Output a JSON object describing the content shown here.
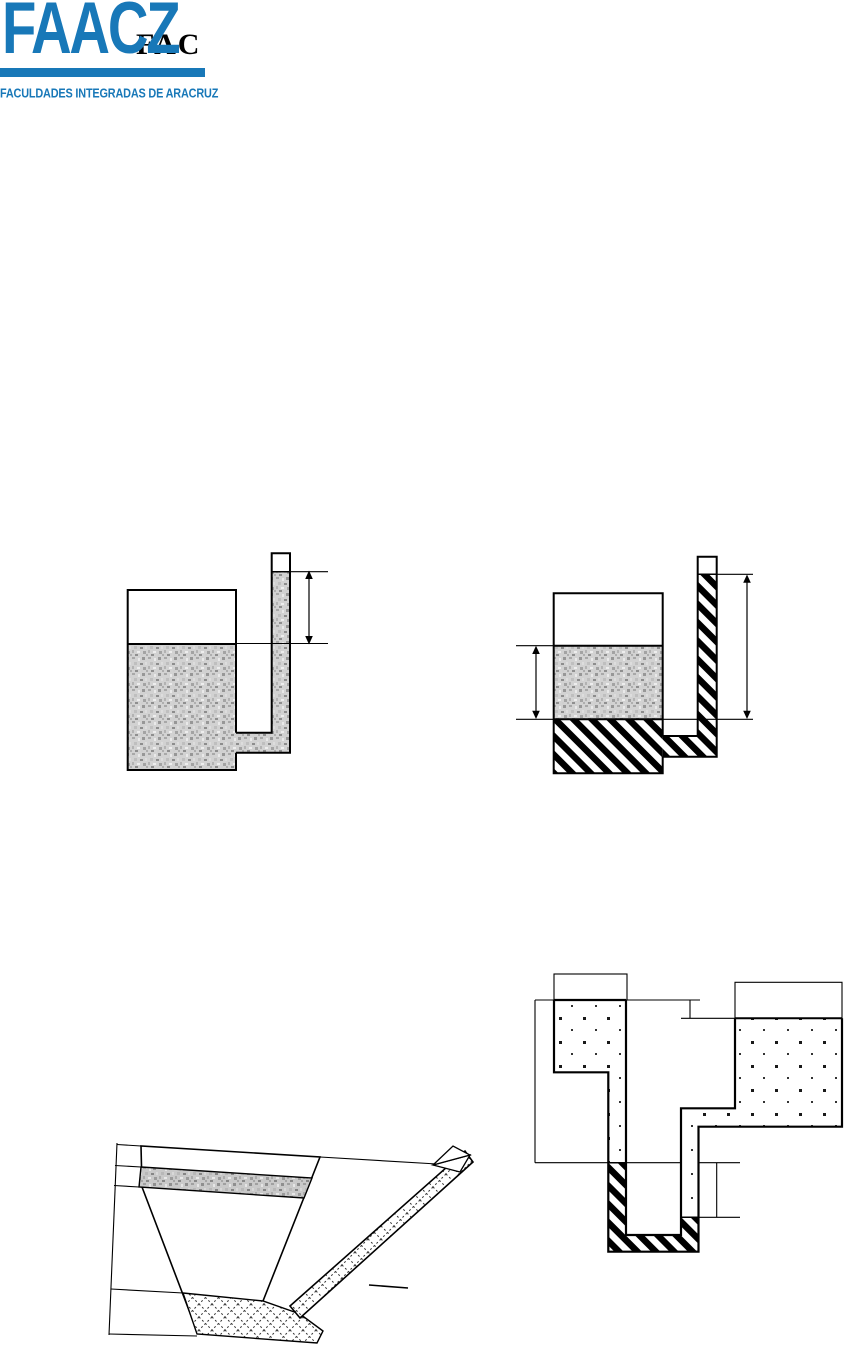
{
  "page": {
    "width": 844,
    "height": 1346,
    "background": "#ffffff"
  },
  "logo": {
    "brand": "FAACZ",
    "brand_color": "#1878b8",
    "watermark": "FAC",
    "watermark_color": "#000000",
    "bar_color": "#1878b8",
    "subtitle": "FACULDADES INTEGRADAS DE ARACRUZ",
    "subtitle_color": "#1878b8"
  },
  "figures": [
    {
      "id": "figure-1",
      "name": "open-tank-with-riser-tube-piezometer",
      "fluid_patterns": [
        "granite-speckle"
      ],
      "annotations": [
        "height-dimension-arrow"
      ]
    },
    {
      "id": "figure-2",
      "name": "two-fluid-tank-with-riser-tube-manometer",
      "fluid_patterns": [
        "granite-speckle",
        "diagonal-stripe"
      ],
      "annotations": [
        "left-height-dimension-arrow",
        "right-height-dimension-arrow"
      ]
    },
    {
      "id": "figure-3",
      "name": "tilted-funnel-tank-with-inclined-tube",
      "fluid_patterns": [
        "granite-speckle",
        "diamond-lattice"
      ],
      "annotations": [
        "reference-level-lines"
      ]
    },
    {
      "id": "figure-4",
      "name": "u-tube-manometer-connecting-two-tanks",
      "fluid_patterns": [
        "square-dots",
        "diagonal-stripe"
      ],
      "annotations": [
        "level-reference-lines",
        "left-height-bracket",
        "right-height-bracket"
      ]
    }
  ],
  "line_color": "#000000"
}
